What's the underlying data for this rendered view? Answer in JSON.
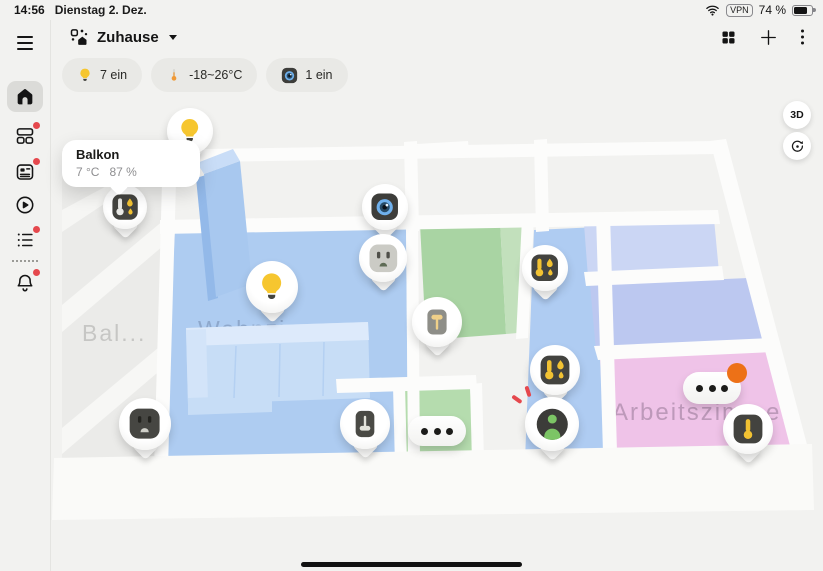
{
  "status_bar": {
    "time": "14:56",
    "date": "Dienstag 2. Dez.",
    "vpn_badge": "VPN",
    "battery_percent": "74 %",
    "battery_level": 74
  },
  "sidebar": {
    "items": [
      {
        "name": "menu",
        "icon": "hamburger-icon",
        "badge": false,
        "active": false
      },
      {
        "name": "home",
        "icon": "home-icon",
        "badge": false,
        "active": true
      },
      {
        "name": "devices",
        "icon": "widgets-icon",
        "badge": true,
        "active": false
      },
      {
        "name": "news",
        "icon": "newspaper-icon",
        "badge": true,
        "active": false
      },
      {
        "name": "media",
        "icon": "play-icon",
        "badge": false,
        "active": false
      },
      {
        "name": "automations",
        "icon": "list-icon",
        "badge": true,
        "active": false
      },
      {
        "name": "notifications",
        "icon": "bell-icon",
        "badge": true,
        "active": false
      }
    ]
  },
  "header": {
    "title": "Zuhause",
    "title_icon": "home-management-icon",
    "action_icons": [
      "grid-icon",
      "add-icon",
      "more-icon"
    ]
  },
  "filter_chips": [
    {
      "name": "lights",
      "icon": "bulb-icon",
      "label": "7 ein"
    },
    {
      "name": "climate",
      "icon": "thermometer-icon",
      "label": "-18~26°C"
    },
    {
      "name": "cameras",
      "icon": "camera-icon",
      "label": "1 ein"
    }
  ],
  "map_controls": {
    "view_3d_label": "3D",
    "rotate_icon": "rotate-icon"
  },
  "tooltip": {
    "title": "Balkon",
    "temperature": "7 °C",
    "humidity": "87 %"
  },
  "room_labels": {
    "balcony": "Bal...",
    "living_room": "Wohnzimmer",
    "office": "Arbeitszimmer"
  },
  "pins": [
    {
      "name": "light-balcony-door",
      "device": "light",
      "icon": "bulb-icon",
      "shape": "drop",
      "x": 190,
      "y": 131,
      "size": 46
    },
    {
      "name": "camera-hall",
      "device": "camera",
      "icon": "camera-icon",
      "shape": "drop",
      "x": 385,
      "y": 207,
      "size": 46
    },
    {
      "name": "climate-balcony",
      "device": "temperature-humidity-sensor",
      "icon": "thermo-humidity-white-icon",
      "shape": "drop",
      "x": 125,
      "y": 207,
      "size": 44
    },
    {
      "name": "socket-hall",
      "device": "socket",
      "icon": "socket-light-icon",
      "shape": "drop",
      "x": 383,
      "y": 258,
      "size": 48
    },
    {
      "name": "light-living-room",
      "device": "light",
      "icon": "bulb-icon",
      "shape": "drop",
      "x": 272,
      "y": 287,
      "size": 52
    },
    {
      "name": "climate-corridor-top",
      "device": "temperature-humidity-sensor",
      "icon": "thermo-humidity-icon",
      "shape": "drop",
      "x": 545,
      "y": 268,
      "size": 46
    },
    {
      "name": "switch-kitchen",
      "device": "wall-switch",
      "icon": "switch-yellow-icon",
      "shape": "drop",
      "x": 437,
      "y": 322,
      "size": 50
    },
    {
      "name": "climate-corridor-bottom",
      "device": "temperature-humidity-sensor",
      "icon": "thermo-humidity-icon",
      "shape": "drop",
      "x": 555,
      "y": 370,
      "size": 50
    },
    {
      "name": "device-group-kitchen",
      "device": "group",
      "icon": "dots-icon",
      "shape": "pill",
      "x": 437,
      "y": 431,
      "w": 58,
      "h": 30
    },
    {
      "name": "presence-corridor",
      "device": "presence-sensor",
      "icon": "person-icon",
      "shape": "drop",
      "x": 552,
      "y": 424,
      "size": 54,
      "alert": true
    },
    {
      "name": "socket-living-room",
      "device": "socket",
      "icon": "socket-dark-icon",
      "shape": "drop",
      "x": 145,
      "y": 424,
      "size": 52
    },
    {
      "name": "switch-living-room",
      "device": "wall-switch",
      "icon": "switch-light-icon",
      "shape": "drop",
      "x": 365,
      "y": 424,
      "size": 50
    },
    {
      "name": "device-group-office",
      "device": "group",
      "icon": "dots-icon",
      "shape": "pill",
      "x": 712,
      "y": 388,
      "w": 58,
      "h": 32,
      "badge": true
    },
    {
      "name": "thermometer-office",
      "device": "thermometer",
      "icon": "thermo-icon",
      "shape": "drop",
      "x": 748,
      "y": 429,
      "size": 50
    }
  ],
  "colors": {
    "accent_yellow": "#F6C62F",
    "alert_red": "#E5484D",
    "badge_orange": "#ED7117",
    "floor_blue": "#AECCF1",
    "floor_green": "#A9D4A3",
    "floor_pink": "#EFC3E8",
    "floor_lavender": "#CBD6F4",
    "background": "#F2F2F0"
  }
}
